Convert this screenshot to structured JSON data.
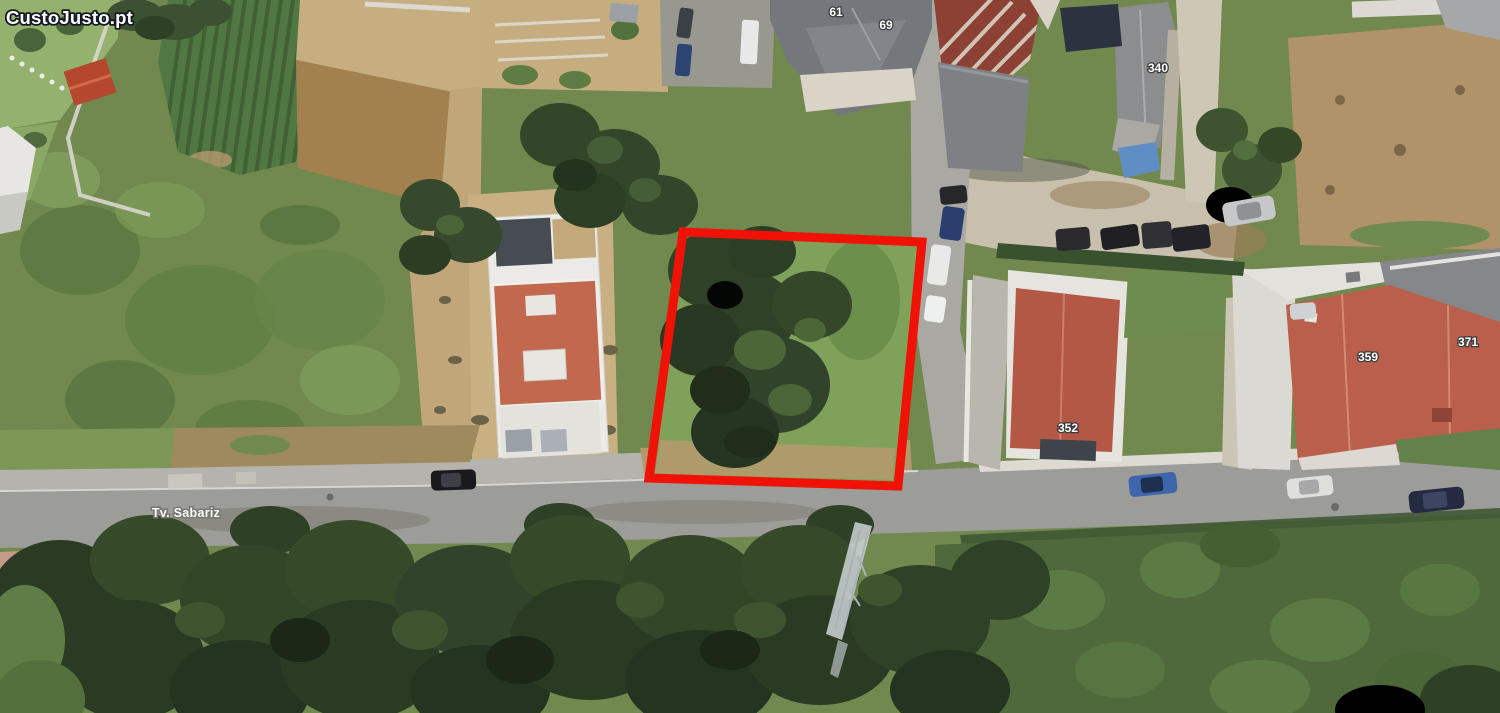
{
  "watermark": {
    "text": "CustoJusto.pt",
    "fill": "#ffffff",
    "outline": "#141b24"
  },
  "map": {
    "street_label": "Tv. Sabariz",
    "house_numbers": {
      "n61": "61",
      "n69": "69",
      "n340": "340",
      "n352": "352",
      "n359": "359",
      "n371": "371"
    },
    "plot_outline_color": "#f01206",
    "label_text_color": "#ffffff"
  },
  "palette": {
    "field_green": "#71894f",
    "tree_green": "#2f4127",
    "road_gray": "#9c9c99",
    "roof_terracotta": "#b45846",
    "sand_tan": "#c2a97e"
  }
}
